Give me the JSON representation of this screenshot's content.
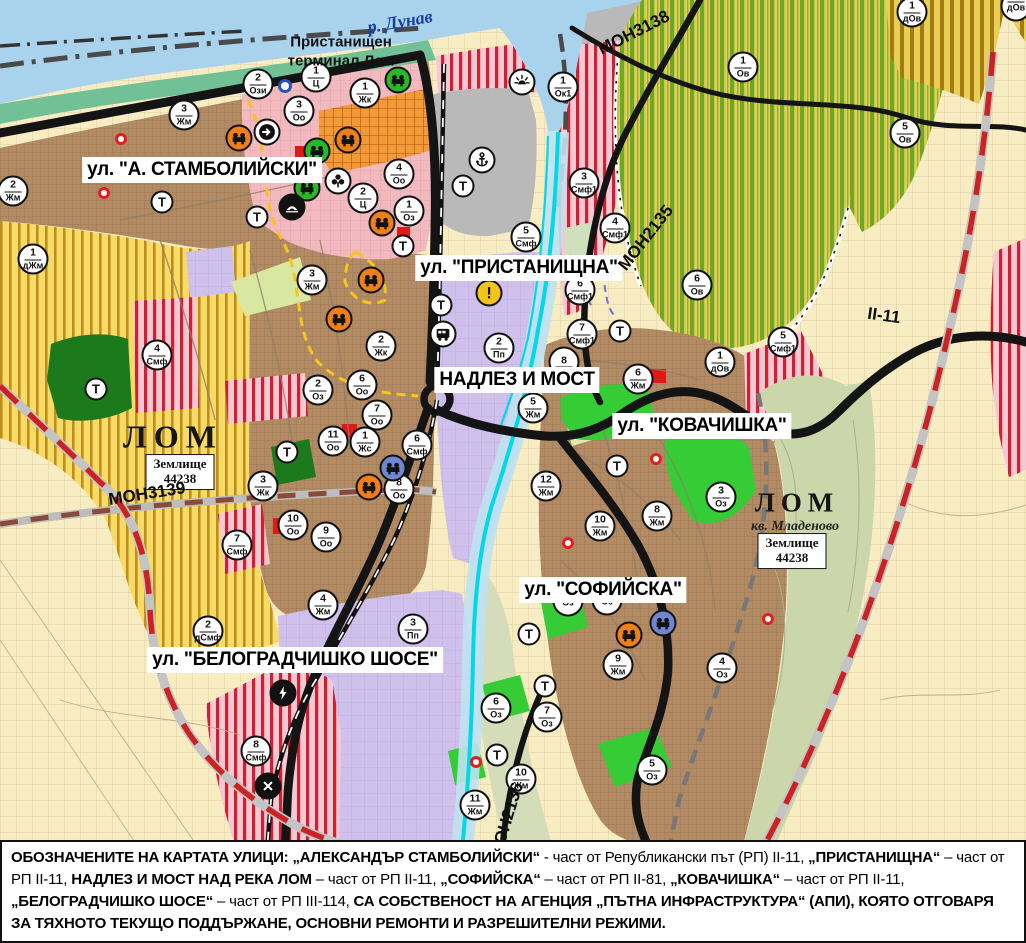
{
  "colors": {
    "water": "#a9d2ec",
    "coast_green": "#72c096",
    "port_gray": "#b9b9b9",
    "fields_cream": "#f8ecc2",
    "vineyard_green_stripe": "#6fa827",
    "vineyard_yellow_stripe": "#bf8c1d",
    "smf_red_stripe": "#d01f30",
    "residential_brown": "#b28a63",
    "production_purple": "#cfc0ec",
    "park_dark_green": "#1c7a1c",
    "park_bright_green": "#35cc35",
    "road_black": "#141414",
    "republican_road_dash": "#cc2222",
    "river_cyan": "#00d9e8"
  },
  "labels": {
    "streets": [
      {
        "text": "ул. \"А. СТАМБОЛИЙСКИ\"",
        "x": 202,
        "y": 170
      },
      {
        "text": "ул. \"ПРИСТАНИЩНА\"",
        "x": 519,
        "y": 268
      },
      {
        "text": "НАДЛЕЗ И МОСТ",
        "x": 517,
        "y": 380
      },
      {
        "text": "ул. \"КОВАЧИШКА\"",
        "x": 702,
        "y": 426
      },
      {
        "text": "ул. \"СОФИЙСКА\"",
        "x": 603,
        "y": 590
      },
      {
        "text": "ул. \"БЕЛОГРАДЧИШКО ШОСЕ\"",
        "x": 295,
        "y": 660
      }
    ],
    "places": [
      {
        "type": "water",
        "text": "р. Дунав",
        "x": 400,
        "y": 22
      },
      {
        "type": "port",
        "text": "Пристанищен\nтерминал Лом",
        "x": 341,
        "y": 52
      },
      {
        "type": "city",
        "text": "ЛОМ",
        "x": 173,
        "y": 437,
        "size": 32
      },
      {
        "type": "city",
        "text": "ЛОМ",
        "x": 797,
        "y": 503,
        "size": 27
      },
      {
        "type": "quarter",
        "text": "кв. Младеново",
        "x": 795,
        "y": 527
      }
    ],
    "land_boxes": [
      {
        "line1": "Землище",
        "line2": "44238",
        "x": 180,
        "y": 472
      },
      {
        "line1": "Землище",
        "line2": "44238",
        "x": 792,
        "y": 551
      }
    ],
    "roads": [
      {
        "text": "МОН3139",
        "x": 147,
        "y": 494,
        "rot": -9
      },
      {
        "text": "МОН2135",
        "x": 646,
        "y": 238,
        "rot": -52
      },
      {
        "text": "МОН3138",
        "x": 634,
        "y": 33,
        "rot": -27
      },
      {
        "text": "МОН2136",
        "x": 507,
        "y": 820,
        "rot": -73
      },
      {
        "text": "II-11",
        "x": 884,
        "y": 316,
        "rot": 8
      }
    ]
  },
  "zone_markers": [
    {
      "n": "2",
      "c": "Ози",
      "x": 258,
      "y": 84
    },
    {
      "n": "1",
      "c": "Ц",
      "x": 316,
      "y": 77
    },
    {
      "n": "3",
      "c": "Оо",
      "x": 299,
      "y": 111
    },
    {
      "n": "1",
      "c": "Жк",
      "x": 365,
      "y": 93
    },
    {
      "n": "3",
      "c": "Жм",
      "x": 184,
      "y": 115
    },
    {
      "n": "2",
      "c": "Жм",
      "x": 13,
      "y": 191
    },
    {
      "n": "1",
      "c": "дЖм",
      "x": 33,
      "y": 259
    },
    {
      "n": "3",
      "c": "Жм",
      "x": 312,
      "y": 280
    },
    {
      "n": "4",
      "c": "Оо",
      "x": 399,
      "y": 174
    },
    {
      "n": "2",
      "c": "Ц",
      "x": 363,
      "y": 198
    },
    {
      "n": "1",
      "c": "Оз",
      "x": 409,
      "y": 211
    },
    {
      "n": "5",
      "c": "Смф",
      "x": 526,
      "y": 237
    },
    {
      "n": "3",
      "c": "Смф1",
      "x": 584,
      "y": 183
    },
    {
      "n": "4",
      "c": "Смф1",
      "x": 615,
      "y": 228
    },
    {
      "n": "6",
      "c": "Смф1",
      "x": 580,
      "y": 290
    },
    {
      "n": "7",
      "c": "Смф1",
      "x": 582,
      "y": 334
    },
    {
      "n": "5",
      "c": "Смф1",
      "x": 783,
      "y": 342
    },
    {
      "n": "6",
      "c": "Ов",
      "x": 697,
      "y": 285
    },
    {
      "n": "1",
      "c": "дОв",
      "x": 720,
      "y": 362
    },
    {
      "n": "1",
      "c": "Ов",
      "x": 743,
      "y": 67
    },
    {
      "n": "5",
      "c": "Ов",
      "x": 905,
      "y": 133
    },
    {
      "n": "1",
      "c": "дОв",
      "x": 912,
      "y": 12
    },
    {
      "n": "",
      "c": "дОв",
      "x": 1016,
      "y": 6
    },
    {
      "n": "1",
      "c": "Ок1",
      "x": 563,
      "y": 87
    },
    {
      "n": "2",
      "c": "Пп",
      "x": 499,
      "y": 348
    },
    {
      "n": "5",
      "c": "Жм",
      "x": 533,
      "y": 408
    },
    {
      "n": "8",
      "c": "",
      "x": 564,
      "y": 362
    },
    {
      "n": "6",
      "c": "Жм",
      "x": 638,
      "y": 379
    },
    {
      "n": "12",
      "c": "Жм",
      "x": 546,
      "y": 486
    },
    {
      "n": "8",
      "c": "Жм",
      "x": 657,
      "y": 516
    },
    {
      "n": "10",
      "c": "Жм",
      "x": 600,
      "y": 526
    },
    {
      "n": "3",
      "c": "Оз",
      "x": 721,
      "y": 497
    },
    {
      "n": "2",
      "c": "Оз",
      "x": 318,
      "y": 390
    },
    {
      "n": "7",
      "c": "Оо",
      "x": 377,
      "y": 415
    },
    {
      "n": "11",
      "c": "Оо",
      "x": 333,
      "y": 441
    },
    {
      "n": "1",
      "c": "Жс",
      "x": 365,
      "y": 442
    },
    {
      "n": "6",
      "c": "Смф",
      "x": 417,
      "y": 445
    },
    {
      "n": "8",
      "c": "Оо",
      "x": 399,
      "y": 489
    },
    {
      "n": "3",
      "c": "Жк",
      "x": 263,
      "y": 486
    },
    {
      "n": "10",
      "c": "Оо",
      "x": 293,
      "y": 525
    },
    {
      "n": "9",
      "c": "Оо",
      "x": 326,
      "y": 537
    },
    {
      "n": "7",
      "c": "Смф",
      "x": 237,
      "y": 545
    },
    {
      "n": "4",
      "c": "Смф",
      "x": 157,
      "y": 355
    },
    {
      "n": "2",
      "c": "Жк",
      "x": 381,
      "y": 346
    },
    {
      "n": "6",
      "c": "Оо",
      "x": 362,
      "y": 385
    },
    {
      "n": "2",
      "c": "дСмф",
      "x": 208,
      "y": 631
    },
    {
      "n": "4",
      "c": "Жм",
      "x": 323,
      "y": 605
    },
    {
      "n": "3",
      "c": "Пп",
      "x": 413,
      "y": 629
    },
    {
      "n": "8",
      "c": "Смф",
      "x": 256,
      "y": 751
    },
    {
      "n": "11",
      "c": "Жм",
      "x": 475,
      "y": 805
    },
    {
      "n": "10",
      "c": "Жм",
      "x": 521,
      "y": 779
    },
    {
      "n": "9",
      "c": "Жм",
      "x": 618,
      "y": 665
    },
    {
      "n": "4",
      "c": "Оз",
      "x": 722,
      "y": 668
    },
    {
      "n": "6",
      "c": "Оз",
      "x": 496,
      "y": 708
    },
    {
      "n": "7",
      "c": "Оз",
      "x": 547,
      "y": 717
    },
    {
      "n": "5",
      "c": "Оз",
      "x": 652,
      "y": 770
    },
    {
      "n": "",
      "c": "Оз",
      "x": 568,
      "y": 601
    },
    {
      "n": "",
      "c": "Оз",
      "x": 607,
      "y": 600
    }
  ],
  "t_markers": {
    "label": "Т",
    "positions": [
      {
        "x": 162,
        "y": 202
      },
      {
        "x": 257,
        "y": 217
      },
      {
        "x": 463,
        "y": 186
      },
      {
        "x": 403,
        "y": 246
      },
      {
        "x": 441,
        "y": 305
      },
      {
        "x": 96,
        "y": 389
      },
      {
        "x": 287,
        "y": 452
      },
      {
        "x": 620,
        "y": 331
      },
      {
        "x": 617,
        "y": 466
      },
      {
        "x": 529,
        "y": 634
      },
      {
        "x": 545,
        "y": 686
      },
      {
        "x": 497,
        "y": 755
      }
    ]
  },
  "icon_markers": [
    {
      "icon": "machine",
      "bg": "#ef8018",
      "x": 239,
      "y": 138
    },
    {
      "icon": "machine",
      "bg": "#ef8018",
      "x": 348,
      "y": 140
    },
    {
      "icon": "machine",
      "bg": "#ef8018",
      "x": 382,
      "y": 223
    },
    {
      "icon": "machine",
      "bg": "#ef8018",
      "x": 371,
      "y": 280
    },
    {
      "icon": "machine",
      "bg": "#ef8018",
      "x": 339,
      "y": 319
    },
    {
      "icon": "machine",
      "bg": "#ef8018",
      "x": 369,
      "y": 487
    },
    {
      "icon": "machine",
      "bg": "#ef8018",
      "x": 629,
      "y": 635
    },
    {
      "icon": "machine",
      "bg": "#28b828",
      "x": 398,
      "y": 80
    },
    {
      "icon": "machine",
      "bg": "#28b828",
      "x": 317,
      "y": 151
    },
    {
      "icon": "machine",
      "bg": "#28b828",
      "x": 307,
      "y": 188
    },
    {
      "icon": "machine",
      "bg": "#6f86d0",
      "x": 393,
      "y": 468
    },
    {
      "icon": "machine",
      "bg": "#6f86d0",
      "x": 663,
      "y": 623
    },
    {
      "icon": "arrow",
      "bg": "#ffffff",
      "x": 267,
      "y": 132
    },
    {
      "icon": "clover",
      "bg": "#ffffff",
      "x": 338,
      "y": 181
    },
    {
      "icon": "tent",
      "bg": "#111111",
      "x": 292,
      "y": 207
    },
    {
      "icon": "anchor",
      "bg": "#ffffff",
      "x": 482,
      "y": 160
    },
    {
      "icon": "sun",
      "bg": "#ffffff",
      "x": 522,
      "y": 82
    },
    {
      "icon": "warning",
      "bg": "#f2c51c",
      "x": 489,
      "y": 293
    },
    {
      "icon": "bus",
      "bg": "#ffffff",
      "x": 443,
      "y": 334
    },
    {
      "icon": "bolt",
      "bg": "#111111",
      "x": 283,
      "y": 693
    },
    {
      "icon": "crossing",
      "bg": "#111111",
      "x": 268,
      "y": 786
    }
  ],
  "point_markers": [
    {
      "kind": "red-dot",
      "x": 121,
      "y": 139
    },
    {
      "kind": "red-dot",
      "x": 104,
      "y": 193
    },
    {
      "kind": "red-dot",
      "x": 568,
      "y": 543
    },
    {
      "kind": "red-dot",
      "x": 656,
      "y": 459
    },
    {
      "kind": "red-dot",
      "x": 476,
      "y": 762
    },
    {
      "kind": "red-dot",
      "x": 768,
      "y": 619
    },
    {
      "kind": "blue-ring",
      "x": 285,
      "y": 86
    }
  ],
  "info_bar": {
    "segments": [
      {
        "b": true,
        "t": "ОБОЗНАЧЕНИТЕ НА КАРТАТА УЛИЦИ: „АЛЕКСАНДЪР СТАМБОЛИЙСКИ“"
      },
      {
        "b": false,
        "t": " - част от Републикански път (РП) II-11, "
      },
      {
        "b": true,
        "t": "„ПРИСТАНИЩНА“"
      },
      {
        "b": false,
        "t": " – част от РП II-11, "
      },
      {
        "b": true,
        "t": "НАДЛЕЗ И МОСТ НАД РЕКА ЛОМ"
      },
      {
        "b": false,
        "t": " – част от РП II-11, "
      },
      {
        "b": true,
        "t": "„СОФИЙСКА“"
      },
      {
        "b": false,
        "t": " – част от РП II-81, "
      },
      {
        "b": true,
        "t": "„КОВАЧИШКА“"
      },
      {
        "b": false,
        "t": " – част от РП II-11, "
      },
      {
        "b": true,
        "t": "„БЕЛОГРАДЧИШКО ШОСЕ“"
      },
      {
        "b": false,
        "t": " – част от РП III-114, "
      },
      {
        "b": true,
        "t": "СА СОБСТВЕНОСТ НА АГЕНЦИЯ „ПЪТНА ИНФРАСТРУКТУРА“ (АПИ), КОЯТО ОТГОВАРЯ ЗА ТЯХНОТО ТЕКУЩО ПОДДЪРЖАНЕ, ОСНОВНИ РЕМОНТИ И РАЗРЕШИТЕЛНИ РЕЖИМИ."
      }
    ]
  }
}
